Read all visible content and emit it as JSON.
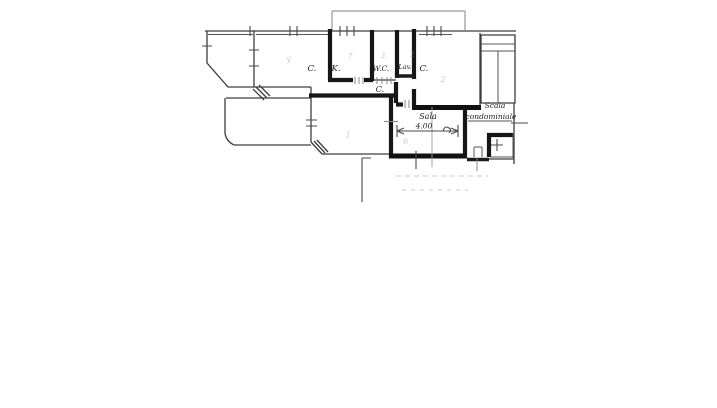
{
  "document": {
    "type": "scanned hand-drawn apartment floor plan",
    "background_color": "#ffffff",
    "ink_color": "#1c1c1c",
    "labels": {
      "room_left": "C.",
      "kitchen": "K.",
      "wc": "W.C.",
      "laundry": "Lav.",
      "room_right": "C.",
      "corridor": "C.",
      "sala": "Sala",
      "dimension_width": "4.00",
      "stairs_line1": "Scala",
      "stairs_line2": "condominiale"
    },
    "faint_marks": {
      "room_left_mark": "y",
      "kitchen_mark": "7",
      "wc_mark": "3",
      "laundry_mark": "2",
      "room_right_mark": "2",
      "living_room_mark": "1",
      "sala_mark": "6"
    }
  }
}
